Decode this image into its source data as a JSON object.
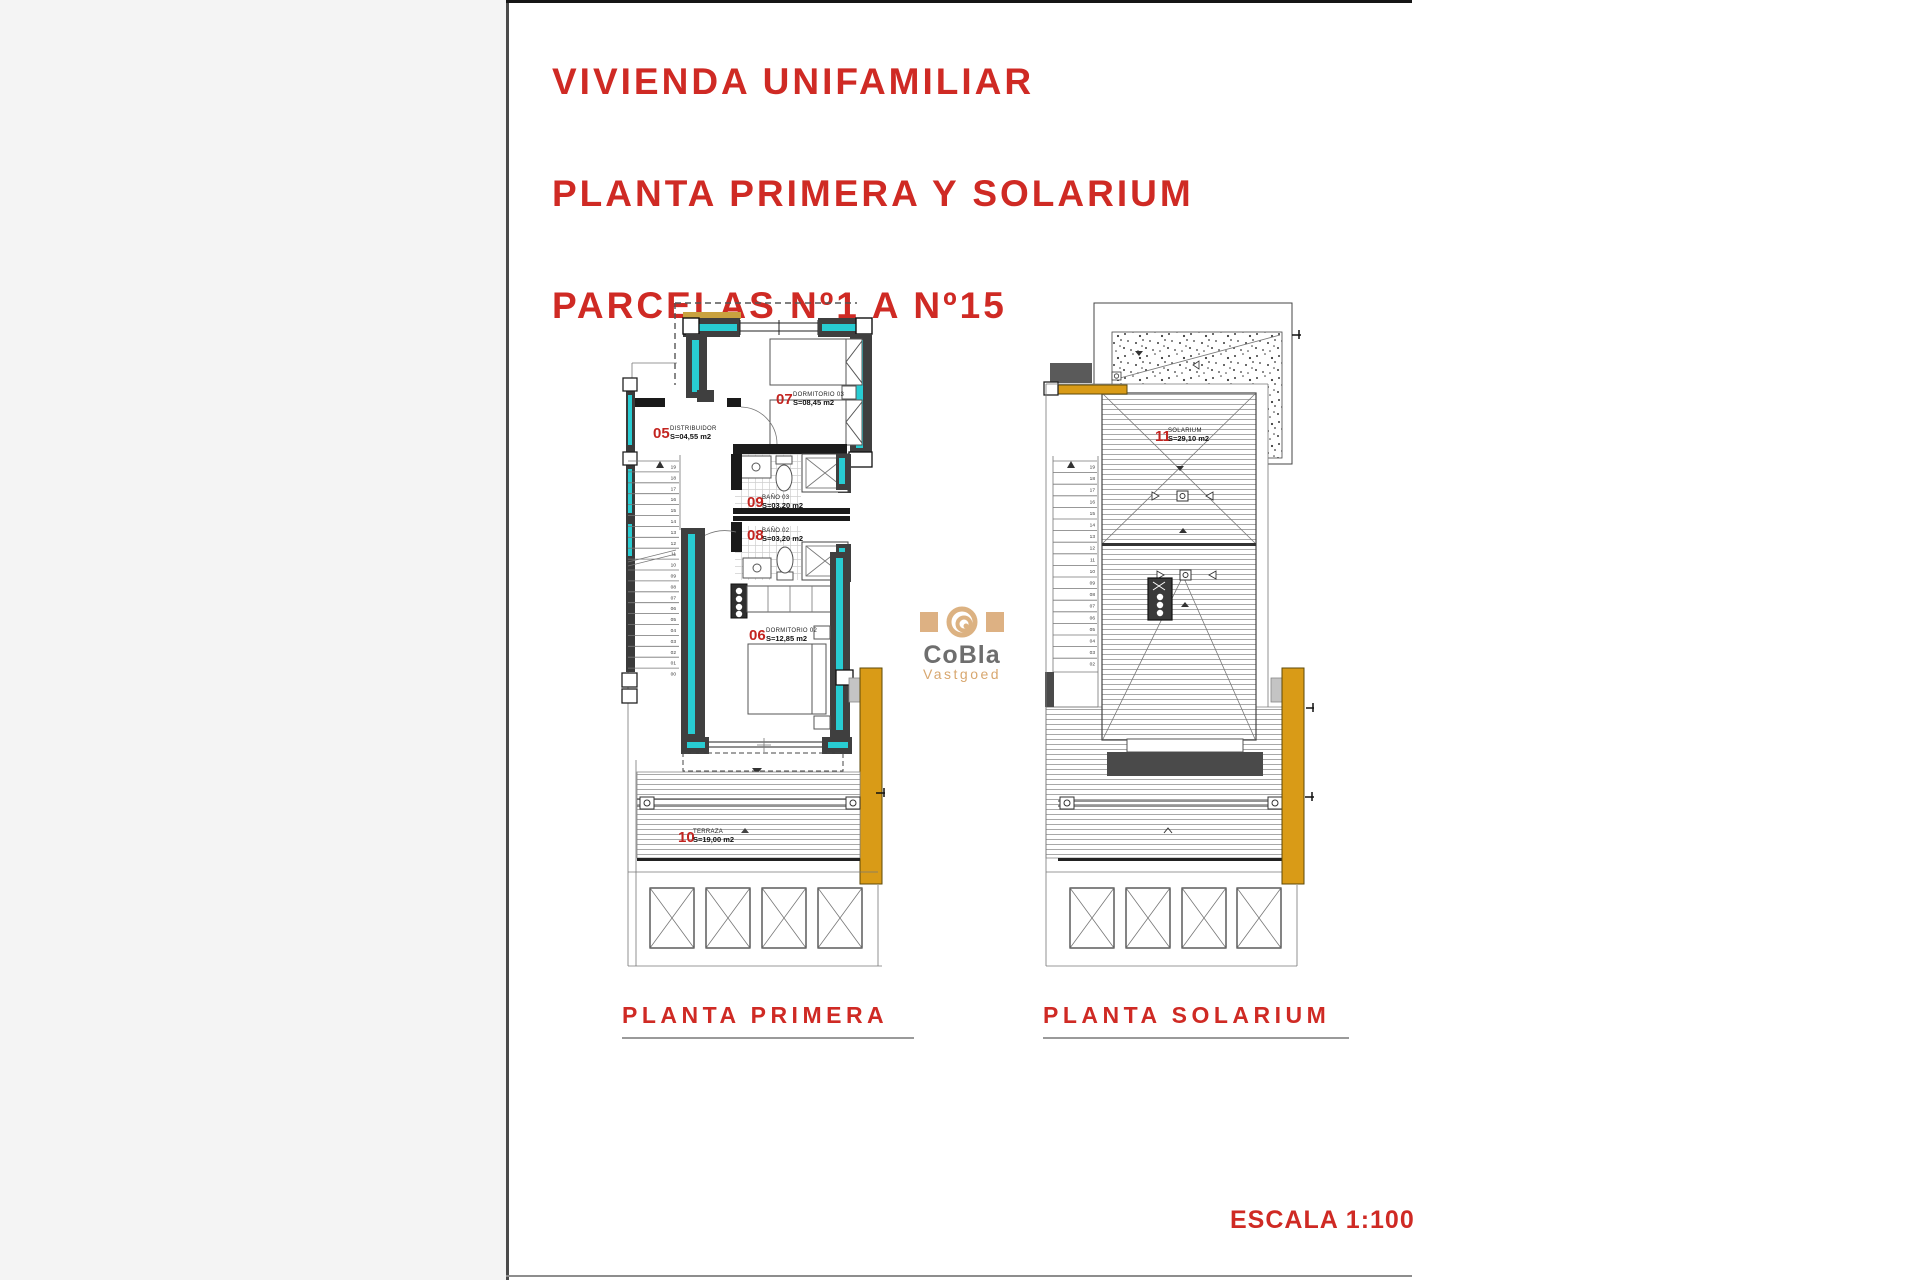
{
  "page": {
    "heading_lines": [
      "VIVIENDA UNIFAMILIAR",
      "PLANTA PRIMERA Y SOLARIUM",
      "PARCELAS Nº1 A Nº15"
    ],
    "scale_label": "ESCALA 1:100"
  },
  "watermark": {
    "brand": "CoBla",
    "subtitle": "Vastgoed"
  },
  "plans": {
    "primera": {
      "title": "PLANTA PRIMERA",
      "rooms": [
        {
          "number": "05",
          "name": "DISTRIBUIDOR",
          "area": "S=04,55 m2"
        },
        {
          "number": "07",
          "name": "DORMITORIO 03",
          "area": "S=08,45 m2"
        },
        {
          "number": "09",
          "name": "BAÑO 03",
          "area": "S=03,20 m2"
        },
        {
          "number": "08",
          "name": "BAÑO 02",
          "area": "S=03,20 m2"
        },
        {
          "number": "06",
          "name": "DORMITORIO 02",
          "area": "S=12,85 m2"
        },
        {
          "number": "10",
          "name": "TERRAZA",
          "area": "S=19,00 m2"
        }
      ],
      "stair_numbers": [
        "19",
        "18",
        "17",
        "16",
        "15",
        "14",
        "13",
        "12",
        "11",
        "10",
        "09",
        "08",
        "07",
        "06",
        "05",
        "04",
        "03",
        "02",
        "01",
        "00"
      ]
    },
    "solarium": {
      "title": "PLANTA SOLARIUM",
      "rooms": [
        {
          "number": "11",
          "name": "SOLARIUM",
          "area": "S=29,10 m2"
        }
      ],
      "stair_numbers": [
        "19",
        "18",
        "17",
        "16",
        "15",
        "14",
        "13",
        "12",
        "11",
        "10",
        "09",
        "08",
        "07",
        "06",
        "05",
        "04",
        "03",
        "02"
      ]
    }
  },
  "colors": {
    "accent_red": "#cf2a24",
    "wall_teal": "#28ccd2",
    "shutter_orange": "#d99b17",
    "wall_dark": "#3f3f3f",
    "underline_gray": "#9a9a9a",
    "logo_tan": "#ddb183"
  }
}
